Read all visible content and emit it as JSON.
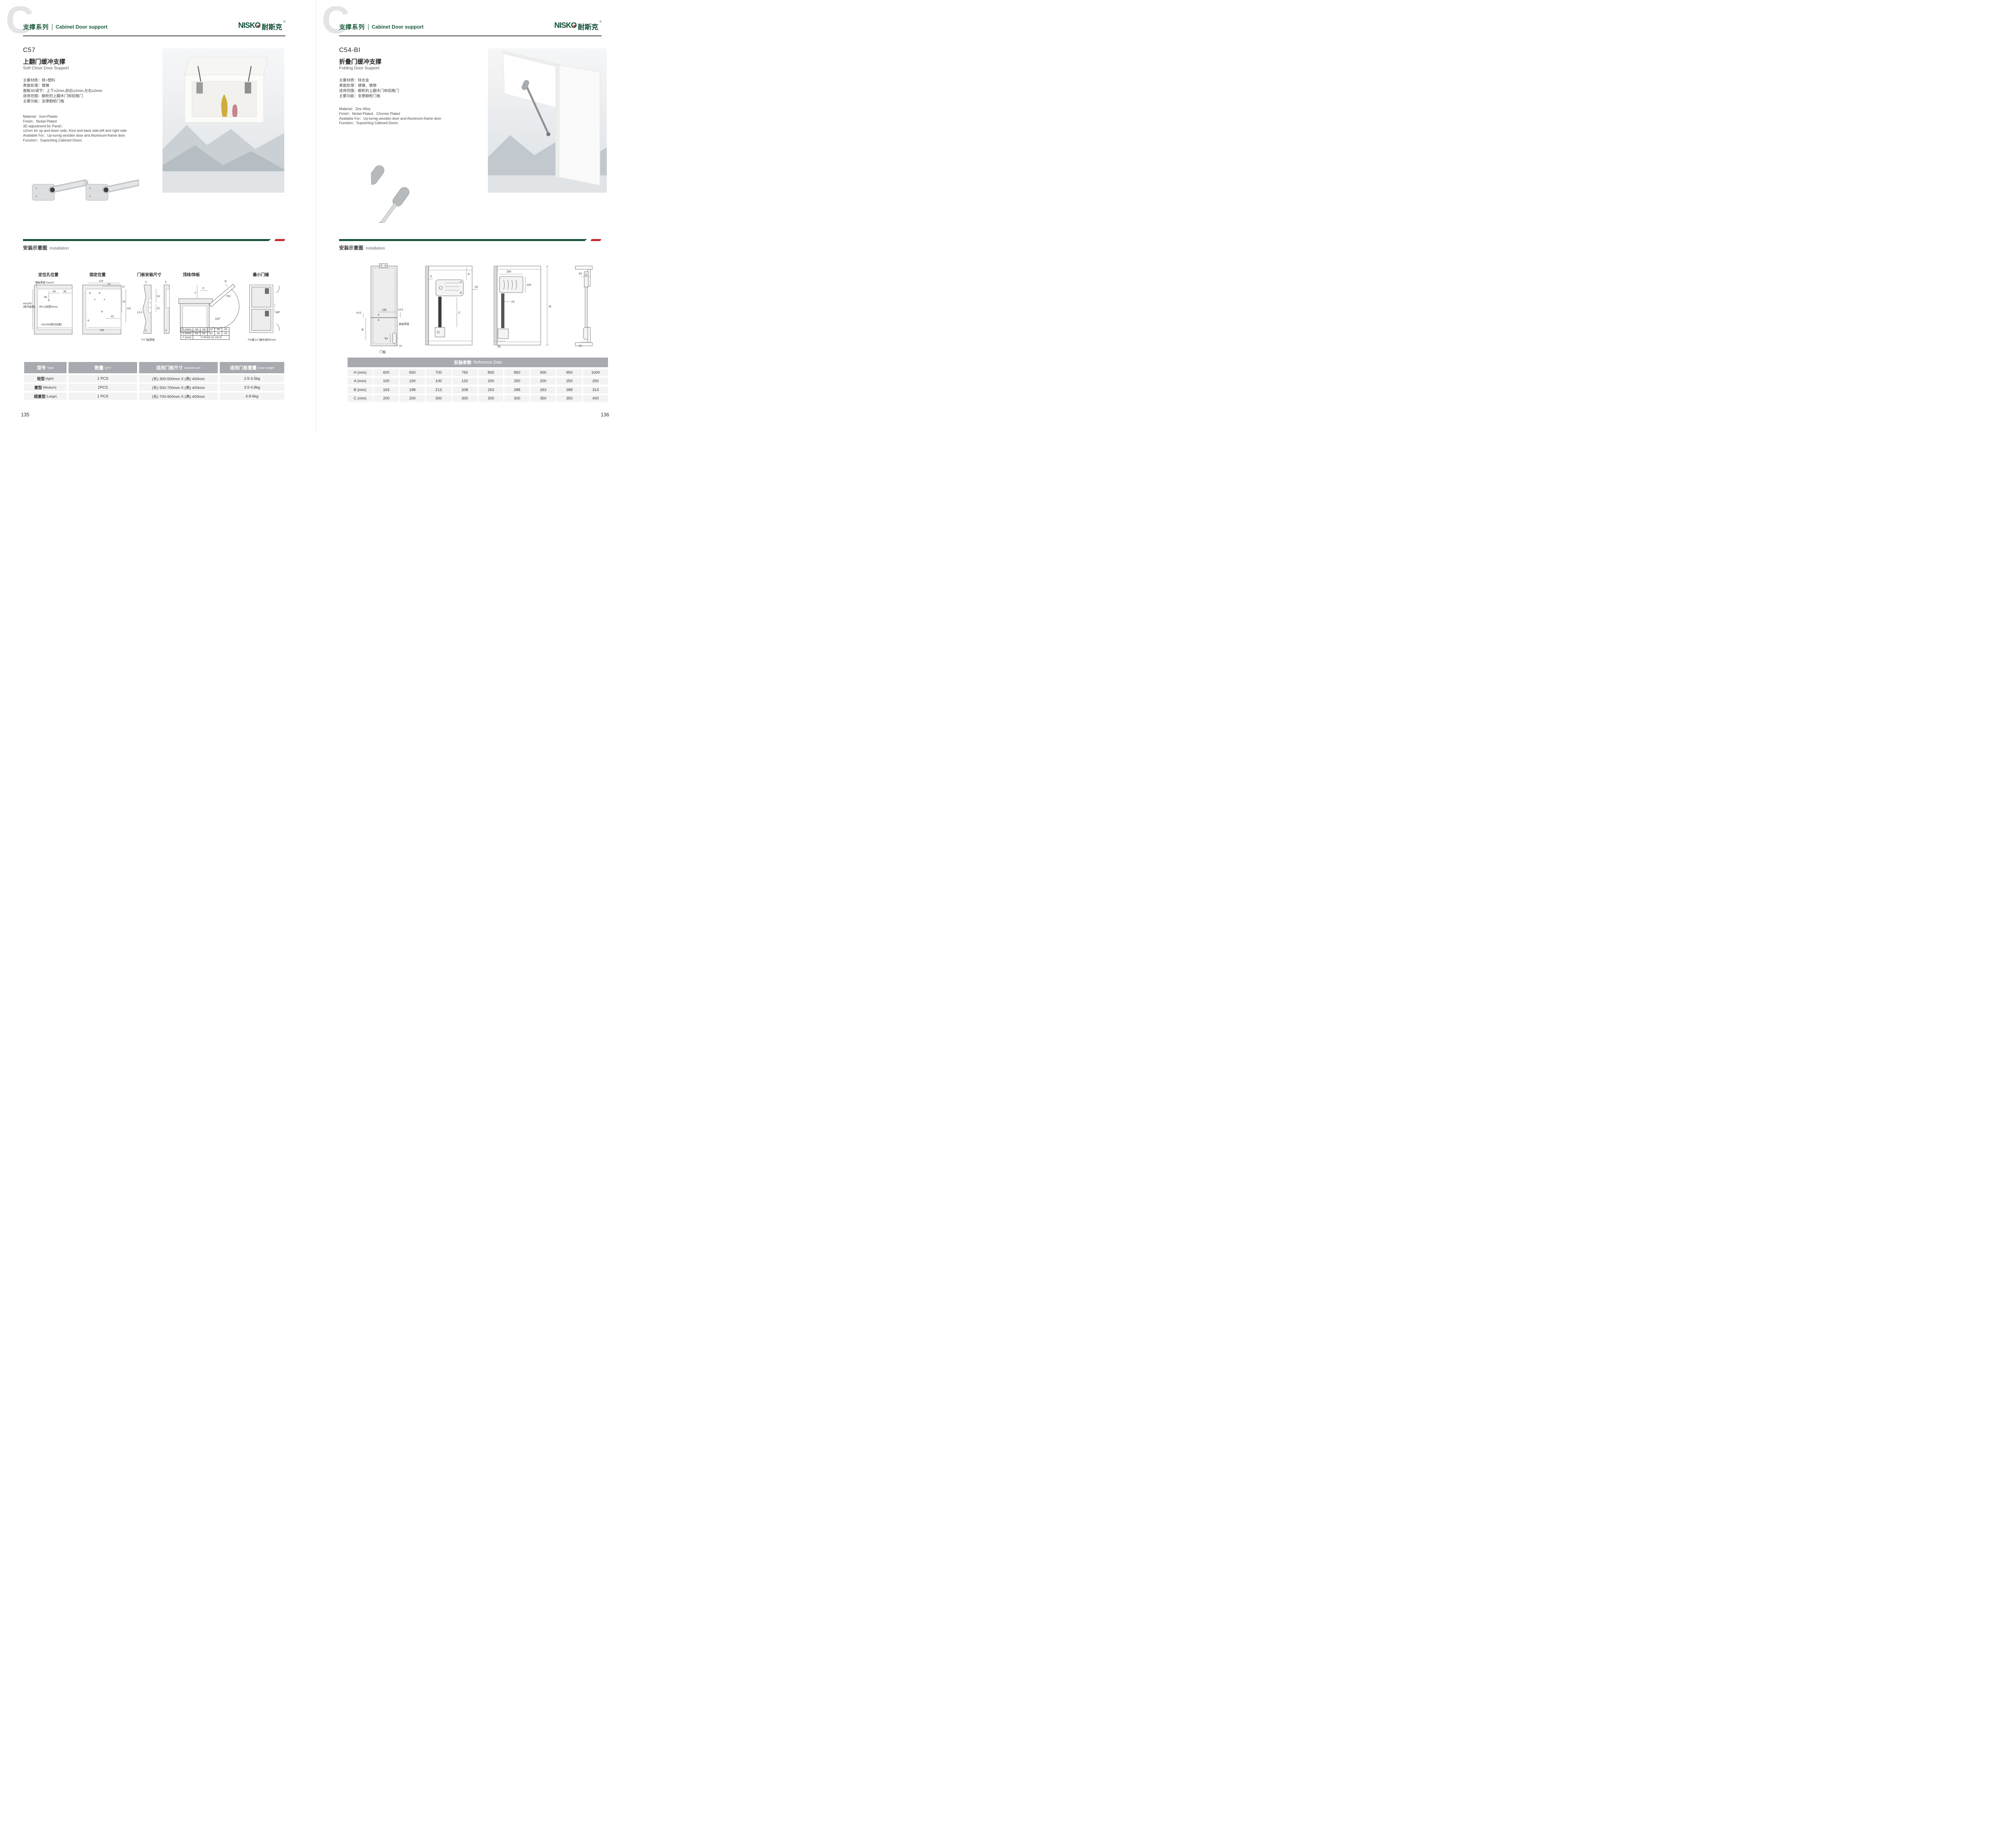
{
  "colors": {
    "brand_green": "#1d5c3c",
    "divider_green": "#1a5638",
    "divider_red": "#c5262c",
    "table_header_gray": "#a7abb0"
  },
  "header": {
    "watermark": "C",
    "series_cn": "支撑系列",
    "series_en": "Cabinet Door support"
  },
  "brand": {
    "name": "NISKO",
    "name_cn": "耐斯克",
    "registered": "®"
  },
  "left_page": {
    "code": "C57",
    "name_cn": "上翻门缓冲支撑",
    "name_en": "Soft Close Door Support",
    "specs_cn": [
      "主要材质：铁+塑料",
      "表面处理：镀镍",
      "面板3D调节：上下±2mm,前后±2mm,左右±2mm",
      "适用范围：橱柜的上翻木门和铝框门",
      "主要功能：支撑橱柜门板"
    ],
    "specs_en": [
      "Material：Iron+Plastic",
      "Finish：Nickel Plated",
      "3D adjustment for Panel：",
      "±2mm for up and down side, front and back side,left and right side",
      "Available For：Up-turnig wooden door and Aluminum-frame door",
      "Function：Supoorting Cabined Doors"
    ],
    "installation": {
      "cn": "安装示意图",
      "en": "Installation"
    },
    "diagrams": {
      "d1": {
        "title": "定位孔位置",
        "top_thickness": "顶板厚度 max22",
        "dim49": "49",
        "dim64": "64",
        "dim36": "36",
        "hole": "Φ5.2(深度5mm)",
        "min_height1": "min200",
        "min_height2": "(柜内高度)",
        "min_depth": "min230(柜内深度)"
      },
      "d2": {
        "title": "固定位置",
        "dim124": "124",
        "dim52": "52",
        "dim12": "12",
        "dim81": "81",
        "dim115": "115",
        "dim42": "42",
        "dim146": "146"
      },
      "d3": {
        "title": "门板安装尺寸",
        "t_top": "T",
        "dim53": "53",
        "dim32": "32",
        "dim125": "12.5",
        "t_bottom": "T",
        "t2_top": "T",
        "t2_bottom": "T",
        "note": "T=门板厚度"
      },
      "d4": {
        "title": "顶线/饰板",
        "y": "Y",
        "x": "X",
        "d": "D",
        "fh": "FH",
        "angle": "110°",
        "table": [
          [
            "D (mm)",
            "16",
            "18",
            "22",
            "26",
            "28"
          ],
          [
            "X (mm)",
            "55",
            "50",
            "42",
            "34",
            "29"
          ],
          [
            "Y (mm)",
            "Y=FHx0.31-15+D"
          ]
        ]
      },
      "d5": {
        "title": "最小门缝",
        "mf": "MF",
        "note": "Fm最小门缝开启时2mm"
      }
    },
    "table": {
      "headers": [
        {
          "cn": "型号",
          "en": "Type"
        },
        {
          "cn": "数量",
          "en": "QTY"
        },
        {
          "cn": "适用门板尺寸",
          "en": "Cabinet size"
        },
        {
          "cn": "适用门板重量",
          "en": "Door weight"
        }
      ],
      "rows": [
        {
          "type_cn": "轻型",
          "type_en": "(light)",
          "qty": "1 PCS",
          "size": "(长) 300-500mm X (高) 400mm",
          "weight": "2.5-3.5kg"
        },
        {
          "type_cn": "重型",
          "type_en": "(Medium)",
          "qty": "1PCS",
          "size": "(长) 500-700mm X (高) 400mm",
          "weight": "3.5-4.8kg"
        },
        {
          "type_cn": "超重型",
          "type_en": "(Large)",
          "qty": "1 PCS",
          "size": "(长) 700-900mm X (高) 400mm",
          "weight": "4.8-6kg"
        }
      ]
    },
    "page_number": "135"
  },
  "right_page": {
    "code": "C54-BI",
    "name_cn": "折叠门缓冲支撑",
    "name_en": "Folding Door Support",
    "specs_cn": [
      "主要材质：锌合金",
      "表面处理：镀镍、镀铬",
      "适用范围：橱柜的上翻木门和铝框门",
      "主要功能：支撑橱柜门板"
    ],
    "specs_en": [
      "Material：Zinc Alloy",
      "Finish：Nickel Plated、Chrome Plated",
      "Available For：Up-turnig wooden door and Aluminum-frame door",
      "Function：Supoorting Cabined Doors"
    ],
    "installation": {
      "cn": "安装示意图",
      "en": "Installation"
    },
    "diagrams": {
      "d1": {
        "label": "门板",
        "dim135": "135",
        "dim145_left": "14.5",
        "dim145_right": "14.5",
        "side_thickness": "侧板厚度",
        "b": "B",
        "dim54": "54",
        "dim12": "12"
      },
      "d2": {
        "dim5": "5",
        "a": "A",
        "dim19": "19",
        "c": "C"
      },
      "d3": {
        "dim193": "193",
        "dim102": "102",
        "dim23": "23",
        "h": "H",
        "dim50": "50"
      },
      "d4": {
        "dim24": "24",
        "dim12": "12"
      }
    },
    "table": {
      "title_cn": "安装参数",
      "title_en": "Reference Data",
      "rows": [
        [
          "H (mm)",
          "600",
          "650",
          "700",
          "750",
          "800",
          "850",
          "900",
          "950",
          "1000"
        ],
        [
          "A (mm)",
          "100",
          "150",
          "100",
          "120",
          "200",
          "250",
          "200",
          "250",
          "250"
        ],
        [
          "B (mm)",
          "163",
          "188",
          "213",
          "208",
          "263",
          "288",
          "263",
          "288",
          "313"
        ],
        [
          "C (mm)",
          "200",
          "200",
          "300",
          "300",
          "300",
          "300",
          "350",
          "350",
          "400"
        ]
      ]
    },
    "page_number": "136"
  }
}
